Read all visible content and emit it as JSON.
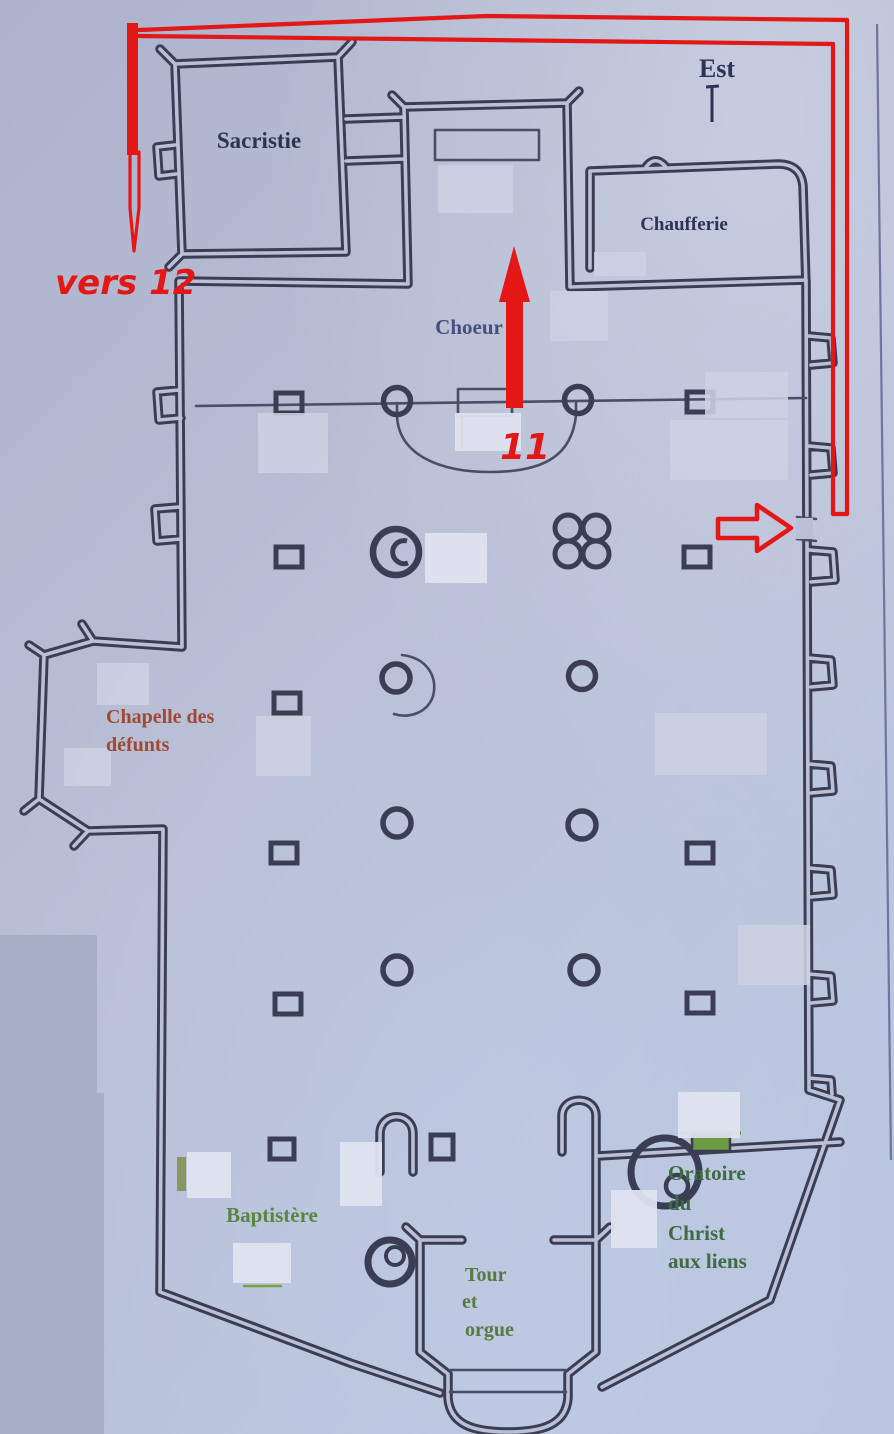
{
  "compass": {
    "label": "Est"
  },
  "rooms": {
    "sacristie": {
      "label": "Sacristie"
    },
    "chaufferie": {
      "label": "Chaufferie"
    },
    "choeur": {
      "label": "Choeur"
    },
    "chapelle_des_defunts": {
      "line1": "Chapelle des",
      "line2": "défunts"
    },
    "baptistere": {
      "label": "Baptistère"
    },
    "tour_et_orgue": {
      "line1": "Tour",
      "line2": "et",
      "line3": "orgue"
    },
    "oratoire_du_christ": {
      "line1": "Oratoire",
      "line2": "du",
      "line3": "Christ",
      "line4": "aux liens"
    }
  },
  "route": {
    "direction_label": "vers 12",
    "station_number": "11",
    "color": "#e41717"
  },
  "colors": {
    "paper": "#b6bcd3",
    "wall_ink": "#3a3d53",
    "navy_text": "#2b3456",
    "green_text": "#4f7c3e",
    "brown_text": "#a04832",
    "annotation_red": "#e41717"
  }
}
